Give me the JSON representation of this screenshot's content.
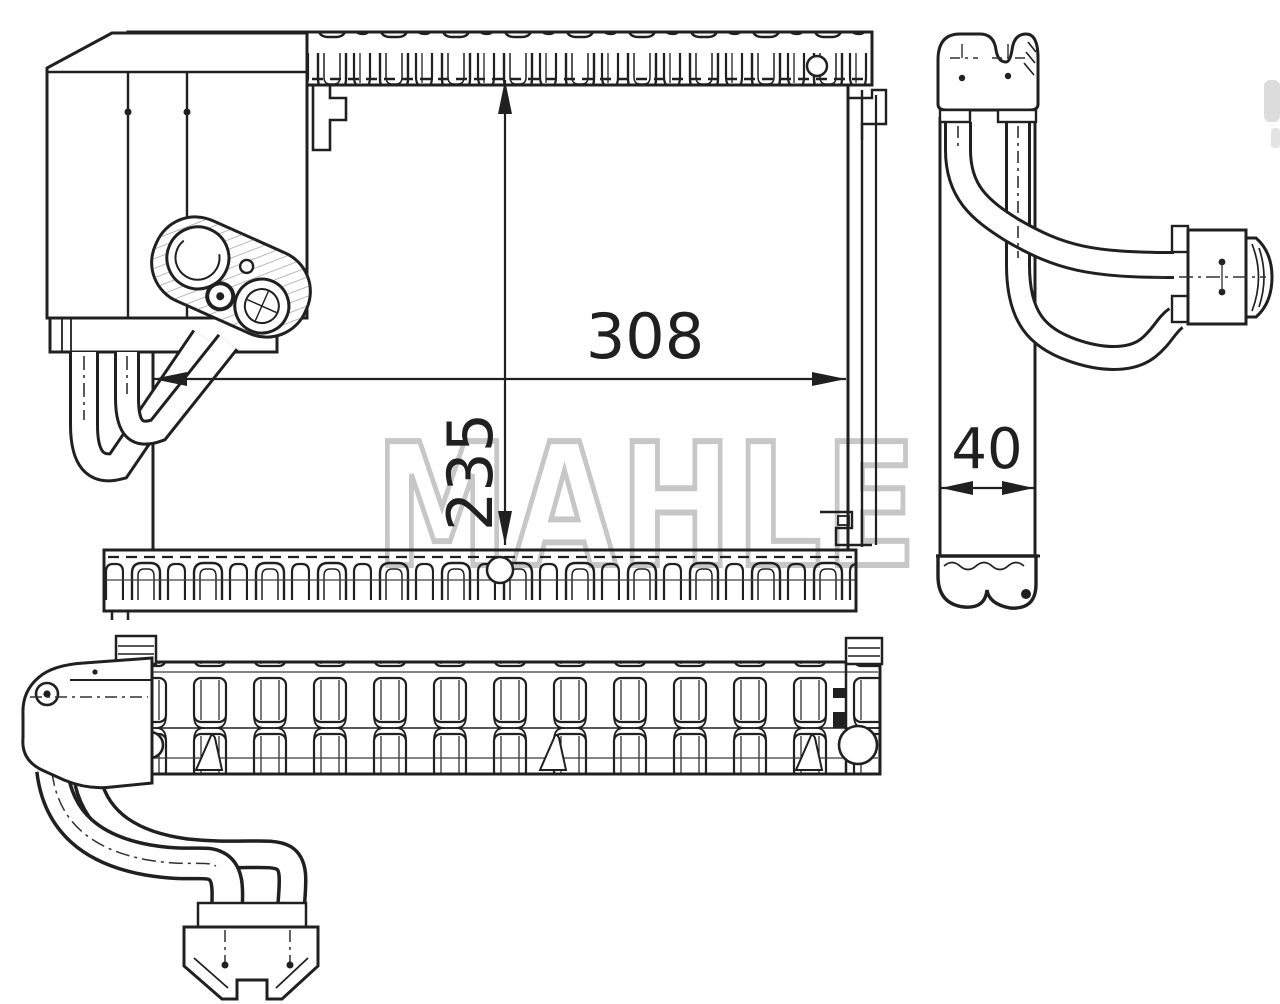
{
  "canvas": {
    "background_color": "#ffffff",
    "line_color": "#202020"
  },
  "watermark": {
    "text": "MAHLE",
    "color": "#c7c7c7"
  },
  "dimensions": {
    "width": "308",
    "height": "235",
    "depth": "40"
  }
}
